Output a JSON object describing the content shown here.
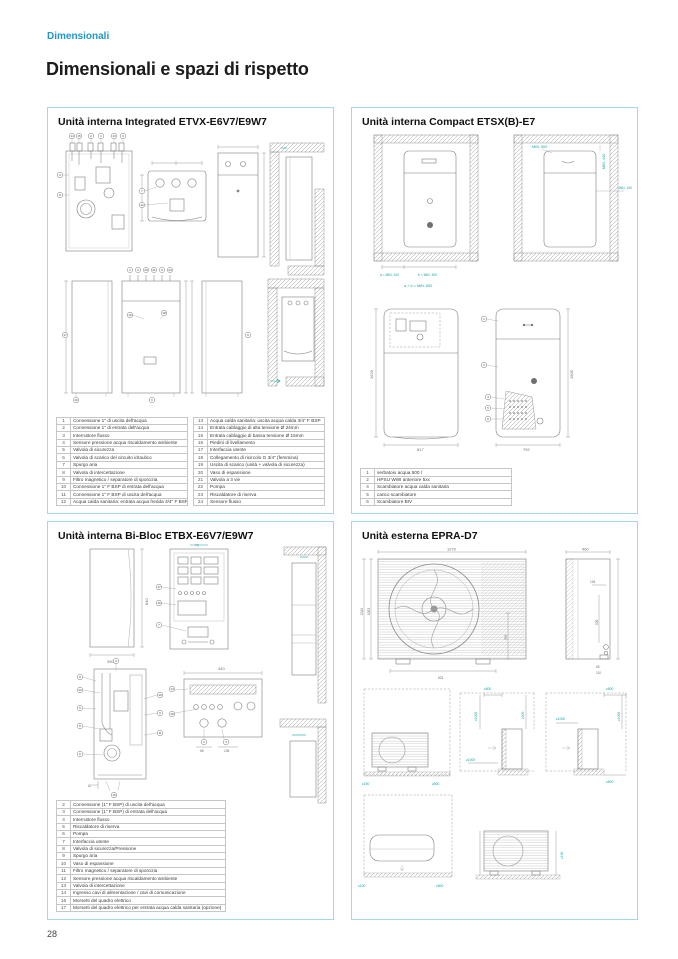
{
  "page": {
    "breadcrumb": "Dimensionali",
    "title": "Dimensionali e spazi di rispetto",
    "page_number": "28"
  },
  "panels": {
    "integrated": {
      "title": "Unità interna Integrated ETVX-E6V7/E9W7",
      "callouts": {
        "top": [
          "14",
          "15",
          "2",
          "1",
          "13",
          "3"
        ],
        "mid": [
          "7",
          "12"
        ],
        "a_side": [
          "4",
          "8"
        ],
        "row2": [
          "1",
          "2",
          "20",
          "21",
          "3",
          "24"
        ],
        "side": [
          "17",
          "9",
          "16",
          "6",
          "19",
          "18"
        ]
      },
      "legend_left": [
        {
          "n": "1",
          "text": "Connessione 1\" di uscita dell'acqua"
        },
        {
          "n": "2",
          "text": "Connessione 1\" di entrata dell'acqua"
        },
        {
          "n": "3",
          "text": "Interruttore flusso"
        },
        {
          "n": "4",
          "text": "Sensore pressione acqua riscaldamento ambiente"
        },
        {
          "n": "5",
          "text": "Valvola di sicurezza"
        },
        {
          "n": "6",
          "text": "Valvola di scarico del circuito idraulico"
        },
        {
          "n": "7",
          "text": "Spurgo aria"
        },
        {
          "n": "8",
          "text": "Valvola di intercettazione"
        },
        {
          "n": "9",
          "text": "Filtro magnetico / separatore di sporcizia"
        },
        {
          "n": "10",
          "text": "Connessione 1\" F BSP di entrata dell'acqua"
        },
        {
          "n": "11",
          "text": "Connessione 1\" F BSP di uscita dell'acqua"
        },
        {
          "n": "12",
          "text": "Acqua calda sanitaria: entrata acqua fredda 3/4\" F BSP"
        }
      ],
      "legend_right": [
        {
          "n": "13",
          "text": "Acqua calda sanitaria: uscita acqua calda 3/4\" F BSP"
        },
        {
          "n": "14",
          "text": "Entrata cablaggio di alta tensione Ø 24mm"
        },
        {
          "n": "15",
          "text": "Entrata cablaggio di bassa tensione Ø 15mm"
        },
        {
          "n": "16",
          "text": "Piedini di livellamento"
        },
        {
          "n": "17",
          "text": "Interfaccia utente"
        },
        {
          "n": "18",
          "text": "Collegamento di ricircolo G 3/4\" (femmina)"
        },
        {
          "n": "19",
          "text": "Uscita di scarico (unità + valvola di sicurezza)"
        },
        {
          "n": "20",
          "text": "Vaso di espansione"
        },
        {
          "n": "21",
          "text": "Valvola a 3 vie"
        },
        {
          "n": "22",
          "text": "Pompa"
        },
        {
          "n": "23",
          "text": "Riscaldatore di riserva"
        },
        {
          "n": "24",
          "text": "Sensore flusso"
        }
      ]
    },
    "compact": {
      "title": "Unità interna Compact ETSX(B)-E7",
      "clearance": {
        "a": "a = MIN. 100",
        "b": "b = MIN. 300",
        "ab": "a + b = MIN. 600",
        "min500": "MIN. 500",
        "min440": "MIN. 440",
        "min100": "MIN. 100"
      },
      "dims": {
        "w1": "817",
        "h1": "1626",
        "w2": "792",
        "h2": "1905"
      },
      "callouts": [
        "1",
        "3",
        "4",
        "5",
        "6"
      ],
      "legend": [
        {
          "n": "1",
          "text": "serbatoio acqua 500 l"
        },
        {
          "n": "2",
          "text": "HPSU WWI anteriore 5xx"
        },
        {
          "n": "4",
          "text": "Scambiatore acqua calda sanitaria"
        },
        {
          "n": "5",
          "text": "carico scambiatore"
        },
        {
          "n": "6",
          "text": "Scambiatore BIV"
        }
      ]
    },
    "bibloc": {
      "title": "Unità interna Bi-Bloc ETBX-E6V7/E9W7",
      "dims": {
        "h": "840",
        "w": "390",
        "top": "79",
        "w2": "440",
        "d68": "68",
        "d108": "108",
        "d62": "62"
      },
      "callouts": [
        "17",
        "16",
        "7",
        "4",
        "9",
        "12",
        "5",
        "8",
        "6",
        "10",
        "9",
        "11",
        "15",
        "14",
        "18",
        "2",
        "3"
      ],
      "legend": [
        {
          "n": "2",
          "text": "Connessione (1\" F BSP) di uscita dell'acqua"
        },
        {
          "n": "3",
          "text": "Connessione (1\" F BSP) di entrata dell'acqua"
        },
        {
          "n": "4",
          "text": "Interruttore flusso"
        },
        {
          "n": "5",
          "text": "Riscaldatore di riserva"
        },
        {
          "n": "6",
          "text": "Pompa"
        },
        {
          "n": "7",
          "text": "Interfaccia utente"
        },
        {
          "n": "8",
          "text": "Valvola di sicurezza/Pressione"
        },
        {
          "n": "9",
          "text": "Spurgo aria"
        },
        {
          "n": "10",
          "text": "Vaso di espansione"
        },
        {
          "n": "11",
          "text": "Filtro magnetico / separatore di sporcizia"
        },
        {
          "n": "12",
          "text": "Sensore pressione acqua riscaldamento ambiente"
        },
        {
          "n": "13",
          "text": "Valvola di intercettazione"
        },
        {
          "n": "14",
          "text": "Ingresso cavi di alimentazione / cavi di comunicazione"
        },
        {
          "n": "16",
          "text": "Morsetti del quadro elettrico"
        },
        {
          "n": "17",
          "text": "Morsetti del quadro elettrico per entrata acqua calda sanitaria (opzione)"
        }
      ]
    },
    "esterna": {
      "title": "Unità esterna EPRA-D7",
      "dims": {
        "w": "1270",
        "h1": "1019",
        "h2": "1003",
        "feet": "823",
        "r": "376",
        "d": "460",
        "s194": "194",
        "s526": "526",
        "s65": "65",
        "s110": "110"
      },
      "clearances": {
        "c1": [
          "≥150",
          "≥500"
        ],
        "c2": [
          "≥500",
          "≥1000",
          "≥300",
          "≥1000"
        ],
        "c3": [
          "≥500",
          "≥1000",
          "≥1000",
          "≥500"
        ],
        "c4": [
          "≥100",
          "≥500"
        ],
        "c5": [
          "≥150"
        ]
      }
    }
  }
}
